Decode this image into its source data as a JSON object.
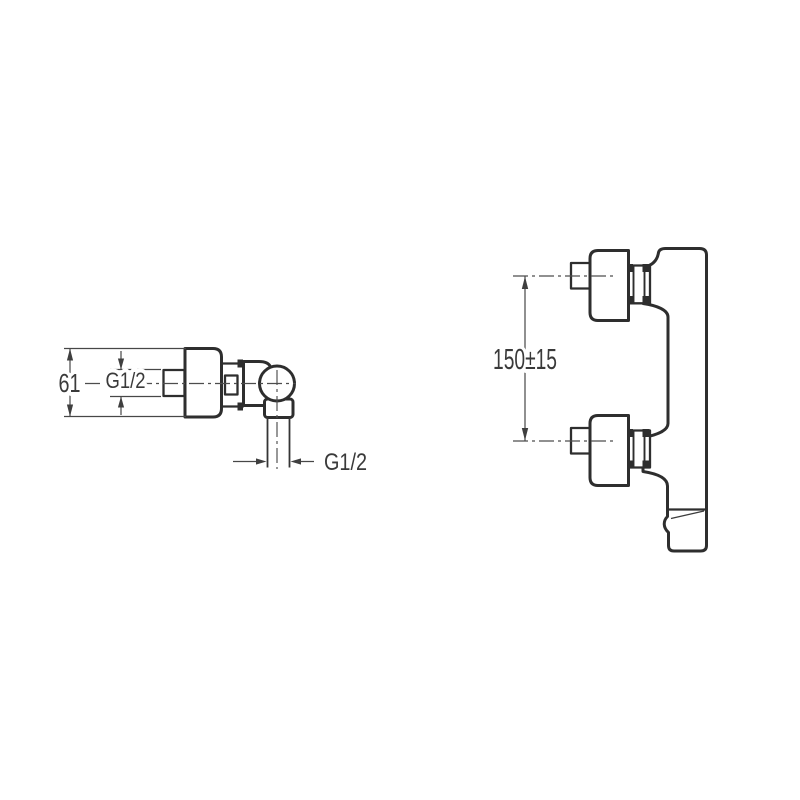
{
  "diagram": {
    "background": "#ffffff",
    "colors": {
      "outline": "#2e2e2e",
      "dimension": "#474747",
      "text": "#3a3a3a"
    },
    "side_view": {
      "height_label": "61",
      "inlet_thread_label": "G1/2",
      "outlet_thread_label": "G1/2"
    },
    "front_view": {
      "port_spacing_label": "150±15"
    }
  }
}
